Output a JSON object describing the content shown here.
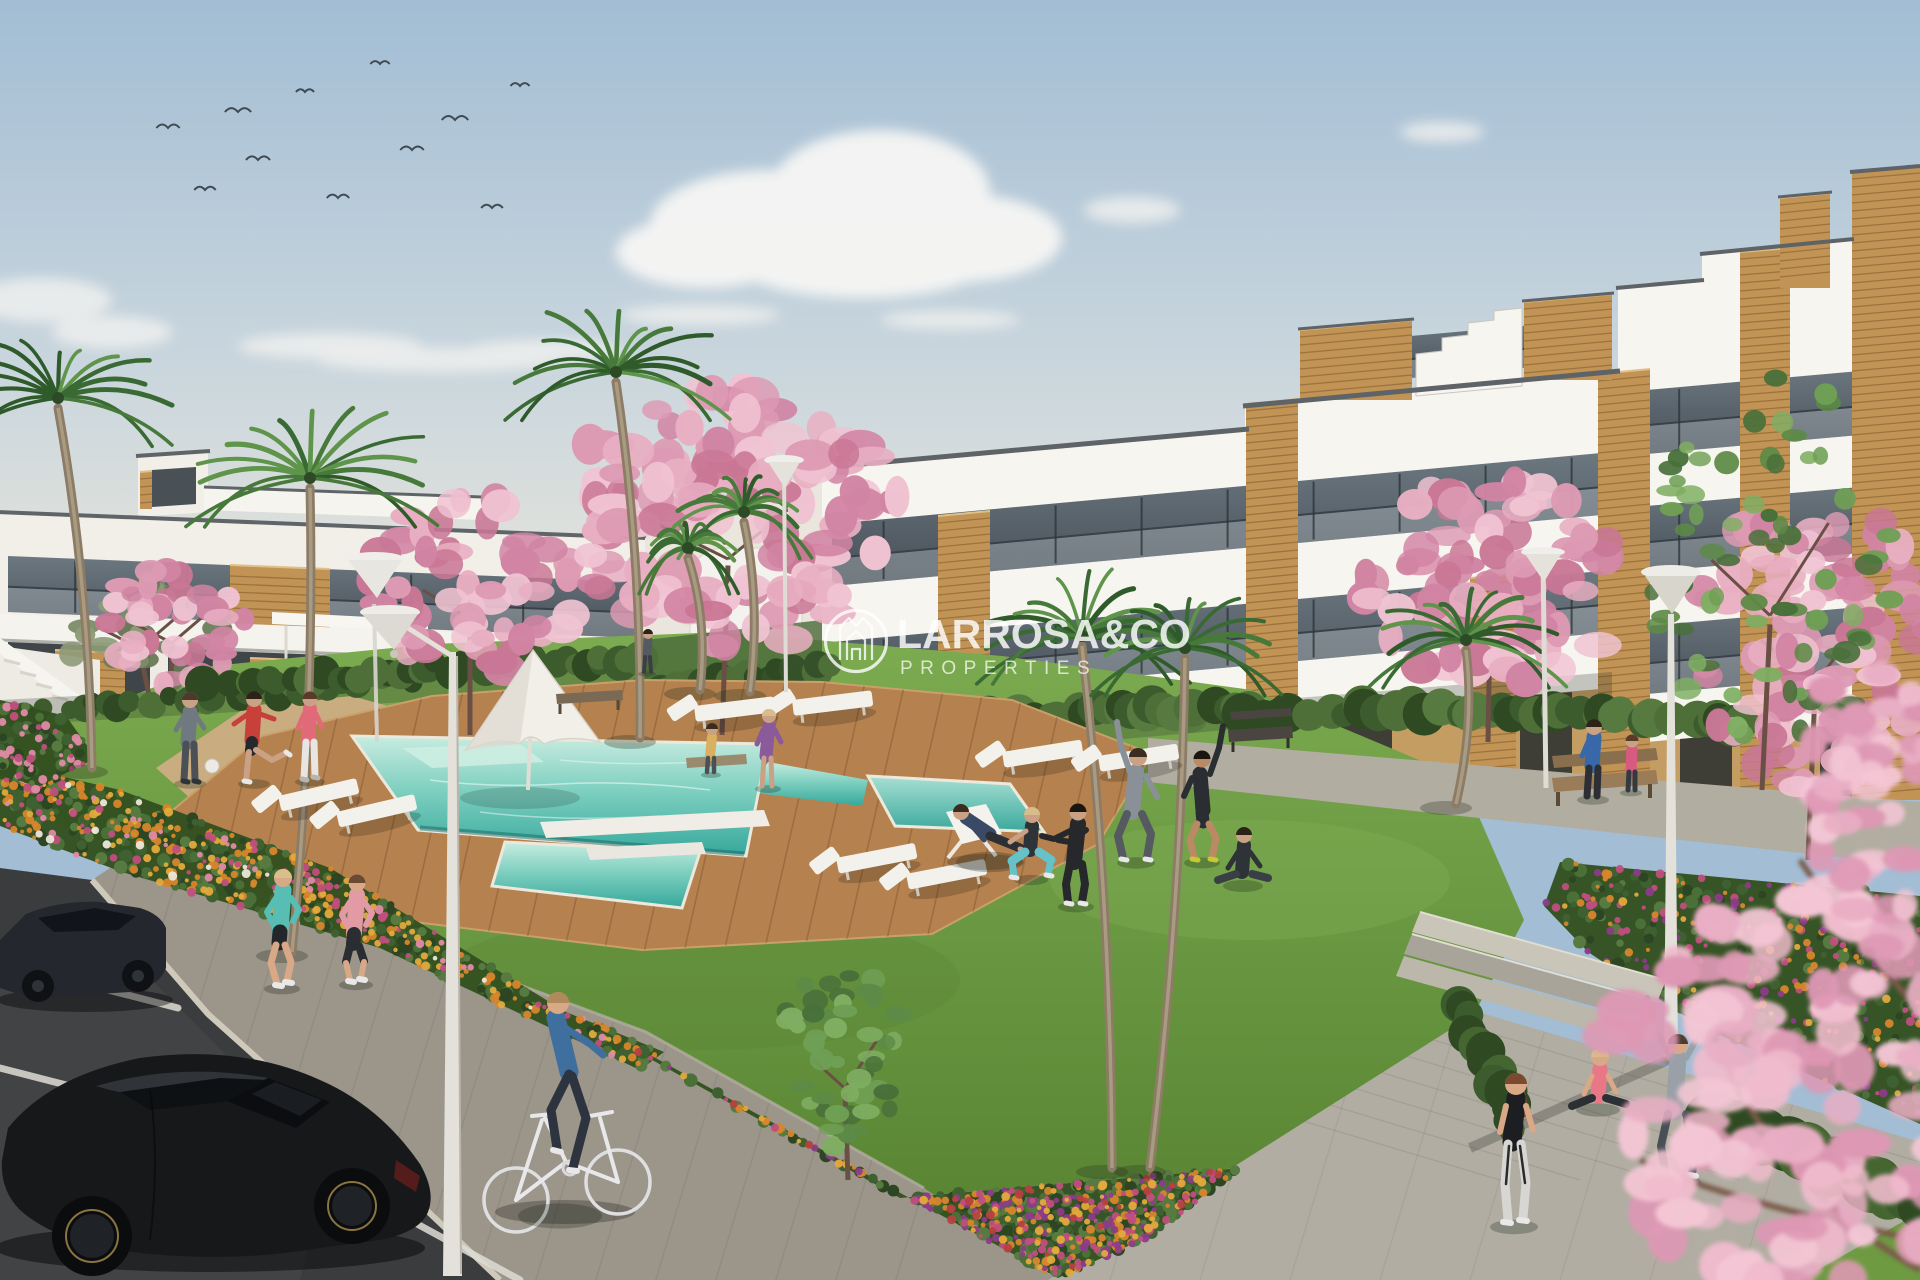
{
  "image": {
    "kind": "3D architectural rendering",
    "subject": "modern residential complex with communal pool, gardens and parking"
  },
  "watermark": {
    "brand": "LARROSA&CO",
    "tagline": "PROPERTIES",
    "icon": "crown-house-circle-logo",
    "text_color": "#ffffff"
  },
  "palette": {
    "sky_top": "#a2bdd4",
    "sky_horizon": "#e9e6dc",
    "building_white": "#f7f5f0",
    "wood_accent": "#c19355",
    "glass": "#4e575e",
    "ground_floor_tan": "#c49d62",
    "grass": "#6e9a41",
    "hedge": "#3c5c2d",
    "pool_water": "#57bfb2",
    "pool_shallow": "#cfeee3",
    "deck_wood": "#b5824f",
    "blossom_pink": "#e3a2b8",
    "flower_orange": "#d7862c",
    "flower_magenta": "#c04f7e",
    "flower_purple": "#8c3c88",
    "asphalt": "#3a3c3e",
    "sidewalk": "#9b958a",
    "plaza": "#b1ada2",
    "car_black": "#17181a",
    "car_grey": "#24272d"
  },
  "scene": {
    "birds_count": 11,
    "buildings": [
      "two-storey apartment wing (left)",
      "four-storey apartment block (right)"
    ],
    "amenities": [
      "swimming pool",
      "spa pool",
      "wooden deck",
      "sun loungers",
      "parasol",
      "benches",
      "street lamps",
      "plaza with steps"
    ],
    "people_activities": [
      "jogging",
      "cycling",
      "stretching",
      "yoga",
      "ball game",
      "sitting on benches"
    ],
    "vehicles": [
      "black hatchback",
      "dark sedan",
      "white bicycle"
    ],
    "vegetation": [
      "palm trees",
      "pink blossom trees",
      "flower beds",
      "hedges",
      "lawn"
    ]
  }
}
